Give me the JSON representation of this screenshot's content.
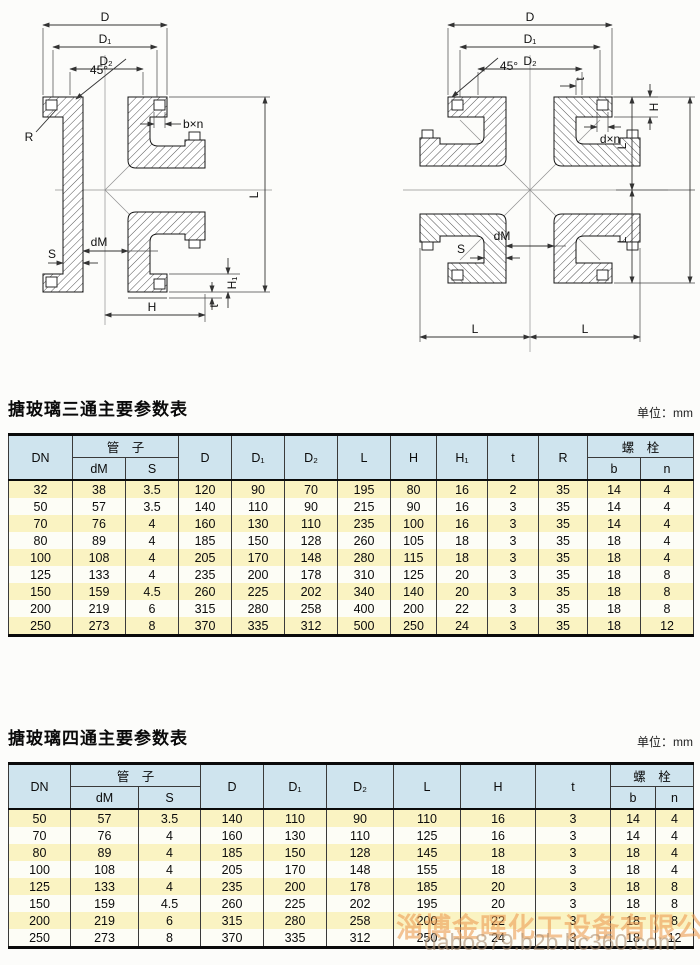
{
  "colors": {
    "header-bg": "#cfe4ee",
    "row-yellow": "#faf3c2",
    "row-white": "#fdfdf6",
    "line-dark": "#3a3a3a",
    "wm-orange": "rgba(236,156,84,0.6)",
    "wm-gray": "rgba(175,145,115,0.62)"
  },
  "diagrams": {
    "left": {
      "labels": {
        "D": "D",
        "D1": "D₁",
        "D2": "D₂",
        "angle": "45°",
        "R": "R",
        "bxn": "b×n",
        "L": "L",
        "dM": "dM",
        "S": "S",
        "H": "H",
        "H1": "H₁",
        "t": "t"
      }
    },
    "right": {
      "labels": {
        "D": "D",
        "D1": "D₁",
        "D2": "D₂",
        "angle": "45°",
        "t": "t",
        "H": "H",
        "dxn": "d×n",
        "L_upper": "L",
        "L_lower": "L",
        "dM": "dM",
        "S": "S",
        "L_bottom_left": "L",
        "L_bottom_right": "L"
      }
    }
  },
  "tables": [
    {
      "title": "搪玻璃三通主要参数表",
      "unit": "单位：mm",
      "head": {
        "dn": "DN",
        "pipe": "管　子",
        "dm": "dM",
        "s": "S",
        "d": "D",
        "d1": "D₁",
        "d2": "D₂",
        "l": "L",
        "h": "H",
        "h1": "H₁",
        "t": "t",
        "r": "R",
        "bolt": "螺　栓",
        "b": "b",
        "n": "n"
      },
      "rows": [
        [
          "32",
          "38",
          "3.5",
          "120",
          "90",
          "70",
          "195",
          "80",
          "16",
          "2",
          "35",
          "14",
          "4"
        ],
        [
          "50",
          "57",
          "3.5",
          "140",
          "110",
          "90",
          "215",
          "90",
          "16",
          "3",
          "35",
          "14",
          "4"
        ],
        [
          "70",
          "76",
          "4",
          "160",
          "130",
          "110",
          "235",
          "100",
          "16",
          "3",
          "35",
          "14",
          "4"
        ],
        [
          "80",
          "89",
          "4",
          "185",
          "150",
          "128",
          "260",
          "105",
          "18",
          "3",
          "35",
          "18",
          "4"
        ],
        [
          "100",
          "108",
          "4",
          "205",
          "170",
          "148",
          "280",
          "115",
          "18",
          "3",
          "35",
          "18",
          "4"
        ],
        [
          "125",
          "133",
          "4",
          "235",
          "200",
          "178",
          "310",
          "125",
          "20",
          "3",
          "35",
          "18",
          "8"
        ],
        [
          "150",
          "159",
          "4.5",
          "260",
          "225",
          "202",
          "340",
          "140",
          "20",
          "3",
          "35",
          "18",
          "8"
        ],
        [
          "200",
          "219",
          "6",
          "315",
          "280",
          "258",
          "400",
          "200",
          "22",
          "3",
          "35",
          "18",
          "8"
        ],
        [
          "250",
          "273",
          "8",
          "370",
          "335",
          "312",
          "500",
          "250",
          "24",
          "3",
          "35",
          "18",
          "12"
        ]
      ]
    },
    {
      "title": "搪玻璃四通主要参数表",
      "unit": "单位：mm",
      "head": {
        "dn": "DN",
        "pipe": "管　子",
        "dm": "dM",
        "s": "S",
        "d": "D",
        "d1": "D₁",
        "d2": "D₂",
        "l": "L",
        "h": "H",
        "t": "t",
        "bolt": "螺　栓",
        "b": "b",
        "n": "n"
      },
      "rows": [
        [
          "50",
          "57",
          "3.5",
          "140",
          "110",
          "90",
          "110",
          "16",
          "3",
          "14",
          "4"
        ],
        [
          "70",
          "76",
          "4",
          "160",
          "130",
          "110",
          "125",
          "16",
          "3",
          "14",
          "4"
        ],
        [
          "80",
          "89",
          "4",
          "185",
          "150",
          "128",
          "145",
          "18",
          "3",
          "18",
          "4"
        ],
        [
          "100",
          "108",
          "4",
          "205",
          "170",
          "148",
          "155",
          "18",
          "3",
          "18",
          "4"
        ],
        [
          "125",
          "133",
          "4",
          "235",
          "200",
          "178",
          "185",
          "20",
          "3",
          "18",
          "8"
        ],
        [
          "150",
          "159",
          "4.5",
          "260",
          "225",
          "202",
          "195",
          "20",
          "3",
          "18",
          "8"
        ],
        [
          "200",
          "219",
          "6",
          "315",
          "280",
          "258",
          "200",
          "22",
          "3",
          "18",
          "8"
        ],
        [
          "250",
          "273",
          "8",
          "370",
          "335",
          "312",
          "250",
          "24",
          "3",
          "18",
          "12"
        ]
      ]
    }
  ],
  "watermark": {
    "company": "淄博金晖化工设备有限公司",
    "url": "dabo879.b2b.hc360.com"
  }
}
